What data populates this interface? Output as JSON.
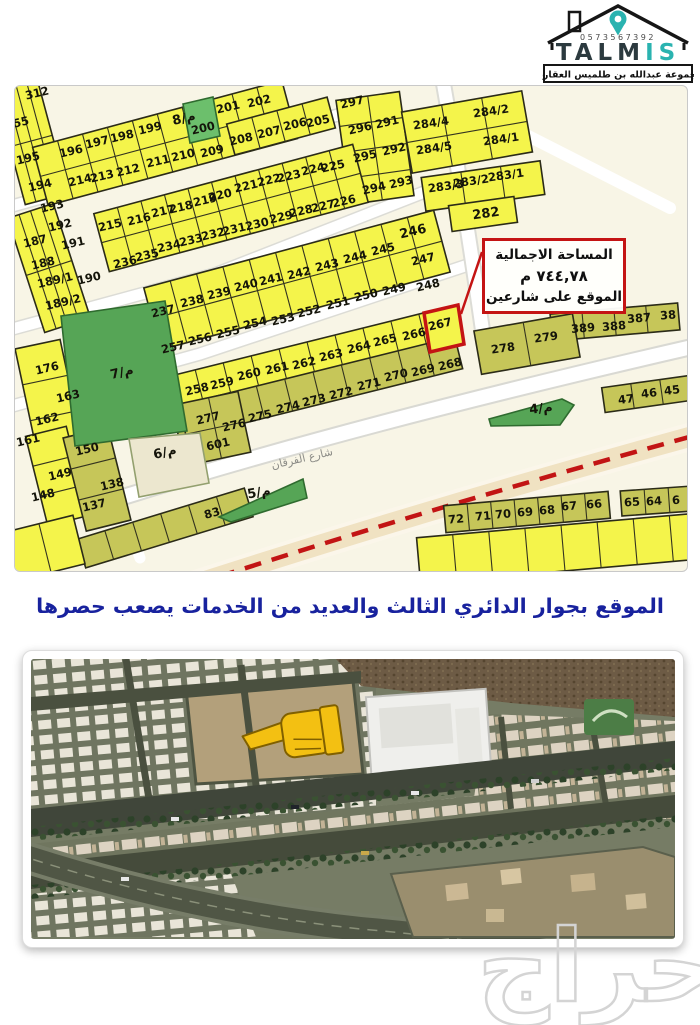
{
  "logo": {
    "phone": "0573567392",
    "brand_dark": "TALM",
    "brand_accent": "IS",
    "subtitle": "مجموعة عبدالله بن طلميس العقارية"
  },
  "map": {
    "street_label": "شارع الفرقان",
    "highlighted_plot": "267",
    "annotation": {
      "line1": "المساحة الاجمالية",
      "line2": "٧٤٤,٧٨ م",
      "line3": "الموقع على شارعين"
    },
    "colors": {
      "plot_yellow": "#f4f44b",
      "plot_olive": "#c6c659",
      "park_green": "#56a556",
      "highlight_red": "#c41414",
      "ring_dash_red": "#c21414",
      "ring_road_beige": "#f0e2c2",
      "background_cream": "#f8f5e6"
    },
    "plots": [
      {
        "t": "312",
        "x": 22,
        "y": 7
      },
      {
        "t": "55",
        "x": 6,
        "y": 36
      },
      {
        "t": "195",
        "x": 13,
        "y": 72
      },
      {
        "t": "196",
        "x": 56,
        "y": 65
      },
      {
        "t": "197",
        "x": 82,
        "y": 56
      },
      {
        "t": "198",
        "x": 107,
        "y": 50
      },
      {
        "t": "199",
        "x": 135,
        "y": 42
      },
      {
        "t": "8/م",
        "x": 169,
        "y": 33,
        "k": "park"
      },
      {
        "t": "200",
        "x": 188,
        "y": 42
      },
      {
        "t": "201",
        "x": 213,
        "y": 21
      },
      {
        "t": "202",
        "x": 244,
        "y": 15
      },
      {
        "t": "209",
        "x": 197,
        "y": 65
      },
      {
        "t": "210",
        "x": 168,
        "y": 69
      },
      {
        "t": "211",
        "x": 143,
        "y": 75
      },
      {
        "t": "212",
        "x": 113,
        "y": 84
      },
      {
        "t": "213",
        "x": 87,
        "y": 90
      },
      {
        "t": "214",
        "x": 65,
        "y": 94
      },
      {
        "t": "194",
        "x": 25,
        "y": 99
      },
      {
        "t": "193",
        "x": 37,
        "y": 120
      },
      {
        "t": "192",
        "x": 45,
        "y": 139
      },
      {
        "t": "191",
        "x": 58,
        "y": 157
      },
      {
        "t": "187",
        "x": 20,
        "y": 155
      },
      {
        "t": "188",
        "x": 28,
        "y": 177
      },
      {
        "t": "189/1",
        "x": 40,
        "y": 194
      },
      {
        "t": "190",
        "x": 74,
        "y": 192
      },
      {
        "t": "189/2",
        "x": 48,
        "y": 216
      },
      {
        "t": "208",
        "x": 226,
        "y": 53
      },
      {
        "t": "207",
        "x": 254,
        "y": 46
      },
      {
        "t": "206",
        "x": 280,
        "y": 38
      },
      {
        "t": "205",
        "x": 303,
        "y": 35
      },
      {
        "t": "297",
        "x": 337,
        "y": 16
      },
      {
        "t": "296",
        "x": 345,
        "y": 42
      },
      {
        "t": "295",
        "x": 350,
        "y": 70
      },
      {
        "t": "291",
        "x": 372,
        "y": 36
      },
      {
        "t": "292",
        "x": 379,
        "y": 63
      },
      {
        "t": "294",
        "x": 359,
        "y": 102
      },
      {
        "t": "293",
        "x": 386,
        "y": 96
      },
      {
        "t": "284/4",
        "x": 416,
        "y": 37,
        "r": -8
      },
      {
        "t": "284/2",
        "x": 476,
        "y": 25,
        "r": -8
      },
      {
        "t": "284/5",
        "x": 419,
        "y": 62,
        "r": -8
      },
      {
        "t": "284/1",
        "x": 486,
        "y": 53,
        "r": -8
      },
      {
        "t": "283/3",
        "x": 431,
        "y": 100,
        "r": -8
      },
      {
        "t": "283/2",
        "x": 456,
        "y": 95,
        "r": -8
      },
      {
        "t": "283/1",
        "x": 491,
        "y": 89,
        "r": -8
      },
      {
        "t": "282",
        "x": 471,
        "y": 128,
        "r": -8,
        "s": 13
      },
      {
        "t": "215",
        "x": 95,
        "y": 139
      },
      {
        "t": "216",
        "x": 124,
        "y": 133
      },
      {
        "t": "217",
        "x": 148,
        "y": 125
      },
      {
        "t": "218",
        "x": 166,
        "y": 121
      },
      {
        "t": "219",
        "x": 190,
        "y": 114
      },
      {
        "t": "220",
        "x": 205,
        "y": 109
      },
      {
        "t": "221",
        "x": 231,
        "y": 100
      },
      {
        "t": "222",
        "x": 254,
        "y": 94
      },
      {
        "t": "223",
        "x": 274,
        "y": 90
      },
      {
        "t": "224",
        "x": 298,
        "y": 83
      },
      {
        "t": "225",
        "x": 318,
        "y": 80
      },
      {
        "t": "226",
        "x": 329,
        "y": 115
      },
      {
        "t": "227",
        "x": 308,
        "y": 120
      },
      {
        "t": "228",
        "x": 286,
        "y": 125
      },
      {
        "t": "229",
        "x": 266,
        "y": 131
      },
      {
        "t": "230",
        "x": 242,
        "y": 138
      },
      {
        "t": "231",
        "x": 219,
        "y": 143
      },
      {
        "t": "232",
        "x": 198,
        "y": 148
      },
      {
        "t": "233",
        "x": 176,
        "y": 154
      },
      {
        "t": "234",
        "x": 154,
        "y": 160
      },
      {
        "t": "235",
        "x": 132,
        "y": 169
      },
      {
        "t": "236",
        "x": 110,
        "y": 176
      },
      {
        "t": "237",
        "x": 148,
        "y": 225
      },
      {
        "t": "238",
        "x": 177,
        "y": 215
      },
      {
        "t": "239",
        "x": 204,
        "y": 207
      },
      {
        "t": "240",
        "x": 231,
        "y": 199
      },
      {
        "t": "241",
        "x": 256,
        "y": 193
      },
      {
        "t": "242",
        "x": 284,
        "y": 187
      },
      {
        "t": "243",
        "x": 312,
        "y": 179
      },
      {
        "t": "244",
        "x": 340,
        "y": 171
      },
      {
        "t": "245",
        "x": 368,
        "y": 163
      },
      {
        "t": "246",
        "x": 398,
        "y": 146,
        "s": 13
      },
      {
        "t": "247",
        "x": 408,
        "y": 173
      },
      {
        "t": "248",
        "x": 413,
        "y": 199
      },
      {
        "t": "249",
        "x": 379,
        "y": 203
      },
      {
        "t": "250",
        "x": 351,
        "y": 209
      },
      {
        "t": "251",
        "x": 323,
        "y": 217
      },
      {
        "t": "252",
        "x": 294,
        "y": 225
      },
      {
        "t": "253",
        "x": 268,
        "y": 233
      },
      {
        "t": "254",
        "x": 240,
        "y": 237
      },
      {
        "t": "255",
        "x": 213,
        "y": 246
      },
      {
        "t": "256",
        "x": 185,
        "y": 253
      },
      {
        "t": "257",
        "x": 158,
        "y": 261
      },
      {
        "t": "258",
        "x": 182,
        "y": 303
      },
      {
        "t": "259",
        "x": 207,
        "y": 297
      },
      {
        "t": "260",
        "x": 234,
        "y": 288
      },
      {
        "t": "261",
        "x": 262,
        "y": 282
      },
      {
        "t": "262",
        "x": 289,
        "y": 277
      },
      {
        "t": "263",
        "x": 316,
        "y": 269
      },
      {
        "t": "264",
        "x": 344,
        "y": 261
      },
      {
        "t": "265",
        "x": 370,
        "y": 254
      },
      {
        "t": "266",
        "x": 399,
        "y": 248
      },
      {
        "t": "267",
        "x": 425,
        "y": 238
      },
      {
        "t": "268",
        "x": 435,
        "y": 278
      },
      {
        "t": "269",
        "x": 408,
        "y": 284
      },
      {
        "t": "270",
        "x": 381,
        "y": 289
      },
      {
        "t": "271",
        "x": 354,
        "y": 298
      },
      {
        "t": "272",
        "x": 326,
        "y": 307
      },
      {
        "t": "273",
        "x": 299,
        "y": 314
      },
      {
        "t": "274",
        "x": 273,
        "y": 321
      },
      {
        "t": "275",
        "x": 245,
        "y": 330
      },
      {
        "t": "276",
        "x": 219,
        "y": 339
      },
      {
        "t": "277",
        "x": 193,
        "y": 332
      },
      {
        "t": "601",
        "x": 203,
        "y": 358
      },
      {
        "t": "176",
        "x": 32,
        "y": 282
      },
      {
        "t": "163",
        "x": 53,
        "y": 310
      },
      {
        "t": "162",
        "x": 32,
        "y": 333
      },
      {
        "t": "161",
        "x": 13,
        "y": 354
      },
      {
        "t": "150",
        "x": 72,
        "y": 363
      },
      {
        "t": "149",
        "x": 45,
        "y": 388
      },
      {
        "t": "148",
        "x": 28,
        "y": 409
      },
      {
        "t": "138",
        "x": 97,
        "y": 398
      },
      {
        "t": "137",
        "x": 79,
        "y": 419
      },
      {
        "t": "83",
        "x": 197,
        "y": 427,
        "r": -16
      },
      {
        "t": "7/م",
        "x": 107,
        "y": 287,
        "k": "park"
      },
      {
        "t": "6/م",
        "x": 150,
        "y": 367,
        "k": "park"
      },
      {
        "t": "5/م",
        "x": 244,
        "y": 407,
        "k": "park",
        "r": -10
      },
      {
        "t": "4/م",
        "x": 526,
        "y": 323,
        "k": "park",
        "r": -6
      },
      {
        "t": "278",
        "x": 488,
        "y": 262,
        "r": -8
      },
      {
        "t": "279",
        "x": 531,
        "y": 251,
        "r": -8
      },
      {
        "t": "389",
        "x": 568,
        "y": 242,
        "r": -5
      },
      {
        "t": "388",
        "x": 599,
        "y": 240,
        "r": -5
      },
      {
        "t": "387",
        "x": 624,
        "y": 232,
        "r": -5
      },
      {
        "t": "38",
        "x": 653,
        "y": 229,
        "r": -5
      },
      {
        "t": "47",
        "x": 611,
        "y": 313,
        "r": -7
      },
      {
        "t": "46",
        "x": 634,
        "y": 307,
        "r": -7
      },
      {
        "t": "45",
        "x": 657,
        "y": 304,
        "r": -7
      },
      {
        "t": "72",
        "x": 441,
        "y": 433,
        "r": -5
      },
      {
        "t": "71",
        "x": 468,
        "y": 430,
        "r": -5
      },
      {
        "t": "70",
        "x": 488,
        "y": 428,
        "r": -5
      },
      {
        "t": "69",
        "x": 510,
        "y": 426,
        "r": -5
      },
      {
        "t": "68",
        "x": 532,
        "y": 424,
        "r": -5
      },
      {
        "t": "67",
        "x": 554,
        "y": 420,
        "r": -5
      },
      {
        "t": "66",
        "x": 579,
        "y": 418,
        "r": -5
      },
      {
        "t": "65",
        "x": 617,
        "y": 416,
        "r": -4
      },
      {
        "t": "64",
        "x": 639,
        "y": 415,
        "r": -4
      },
      {
        "t": "6",
        "x": 661,
        "y": 414,
        "r": -4
      }
    ]
  },
  "caption": {
    "text": "الموقع بجوار الدائري الثالث والعديد من الخدمات يصعب حصرها",
    "color": "#18229e"
  },
  "watermark": {
    "text": "حراج"
  }
}
